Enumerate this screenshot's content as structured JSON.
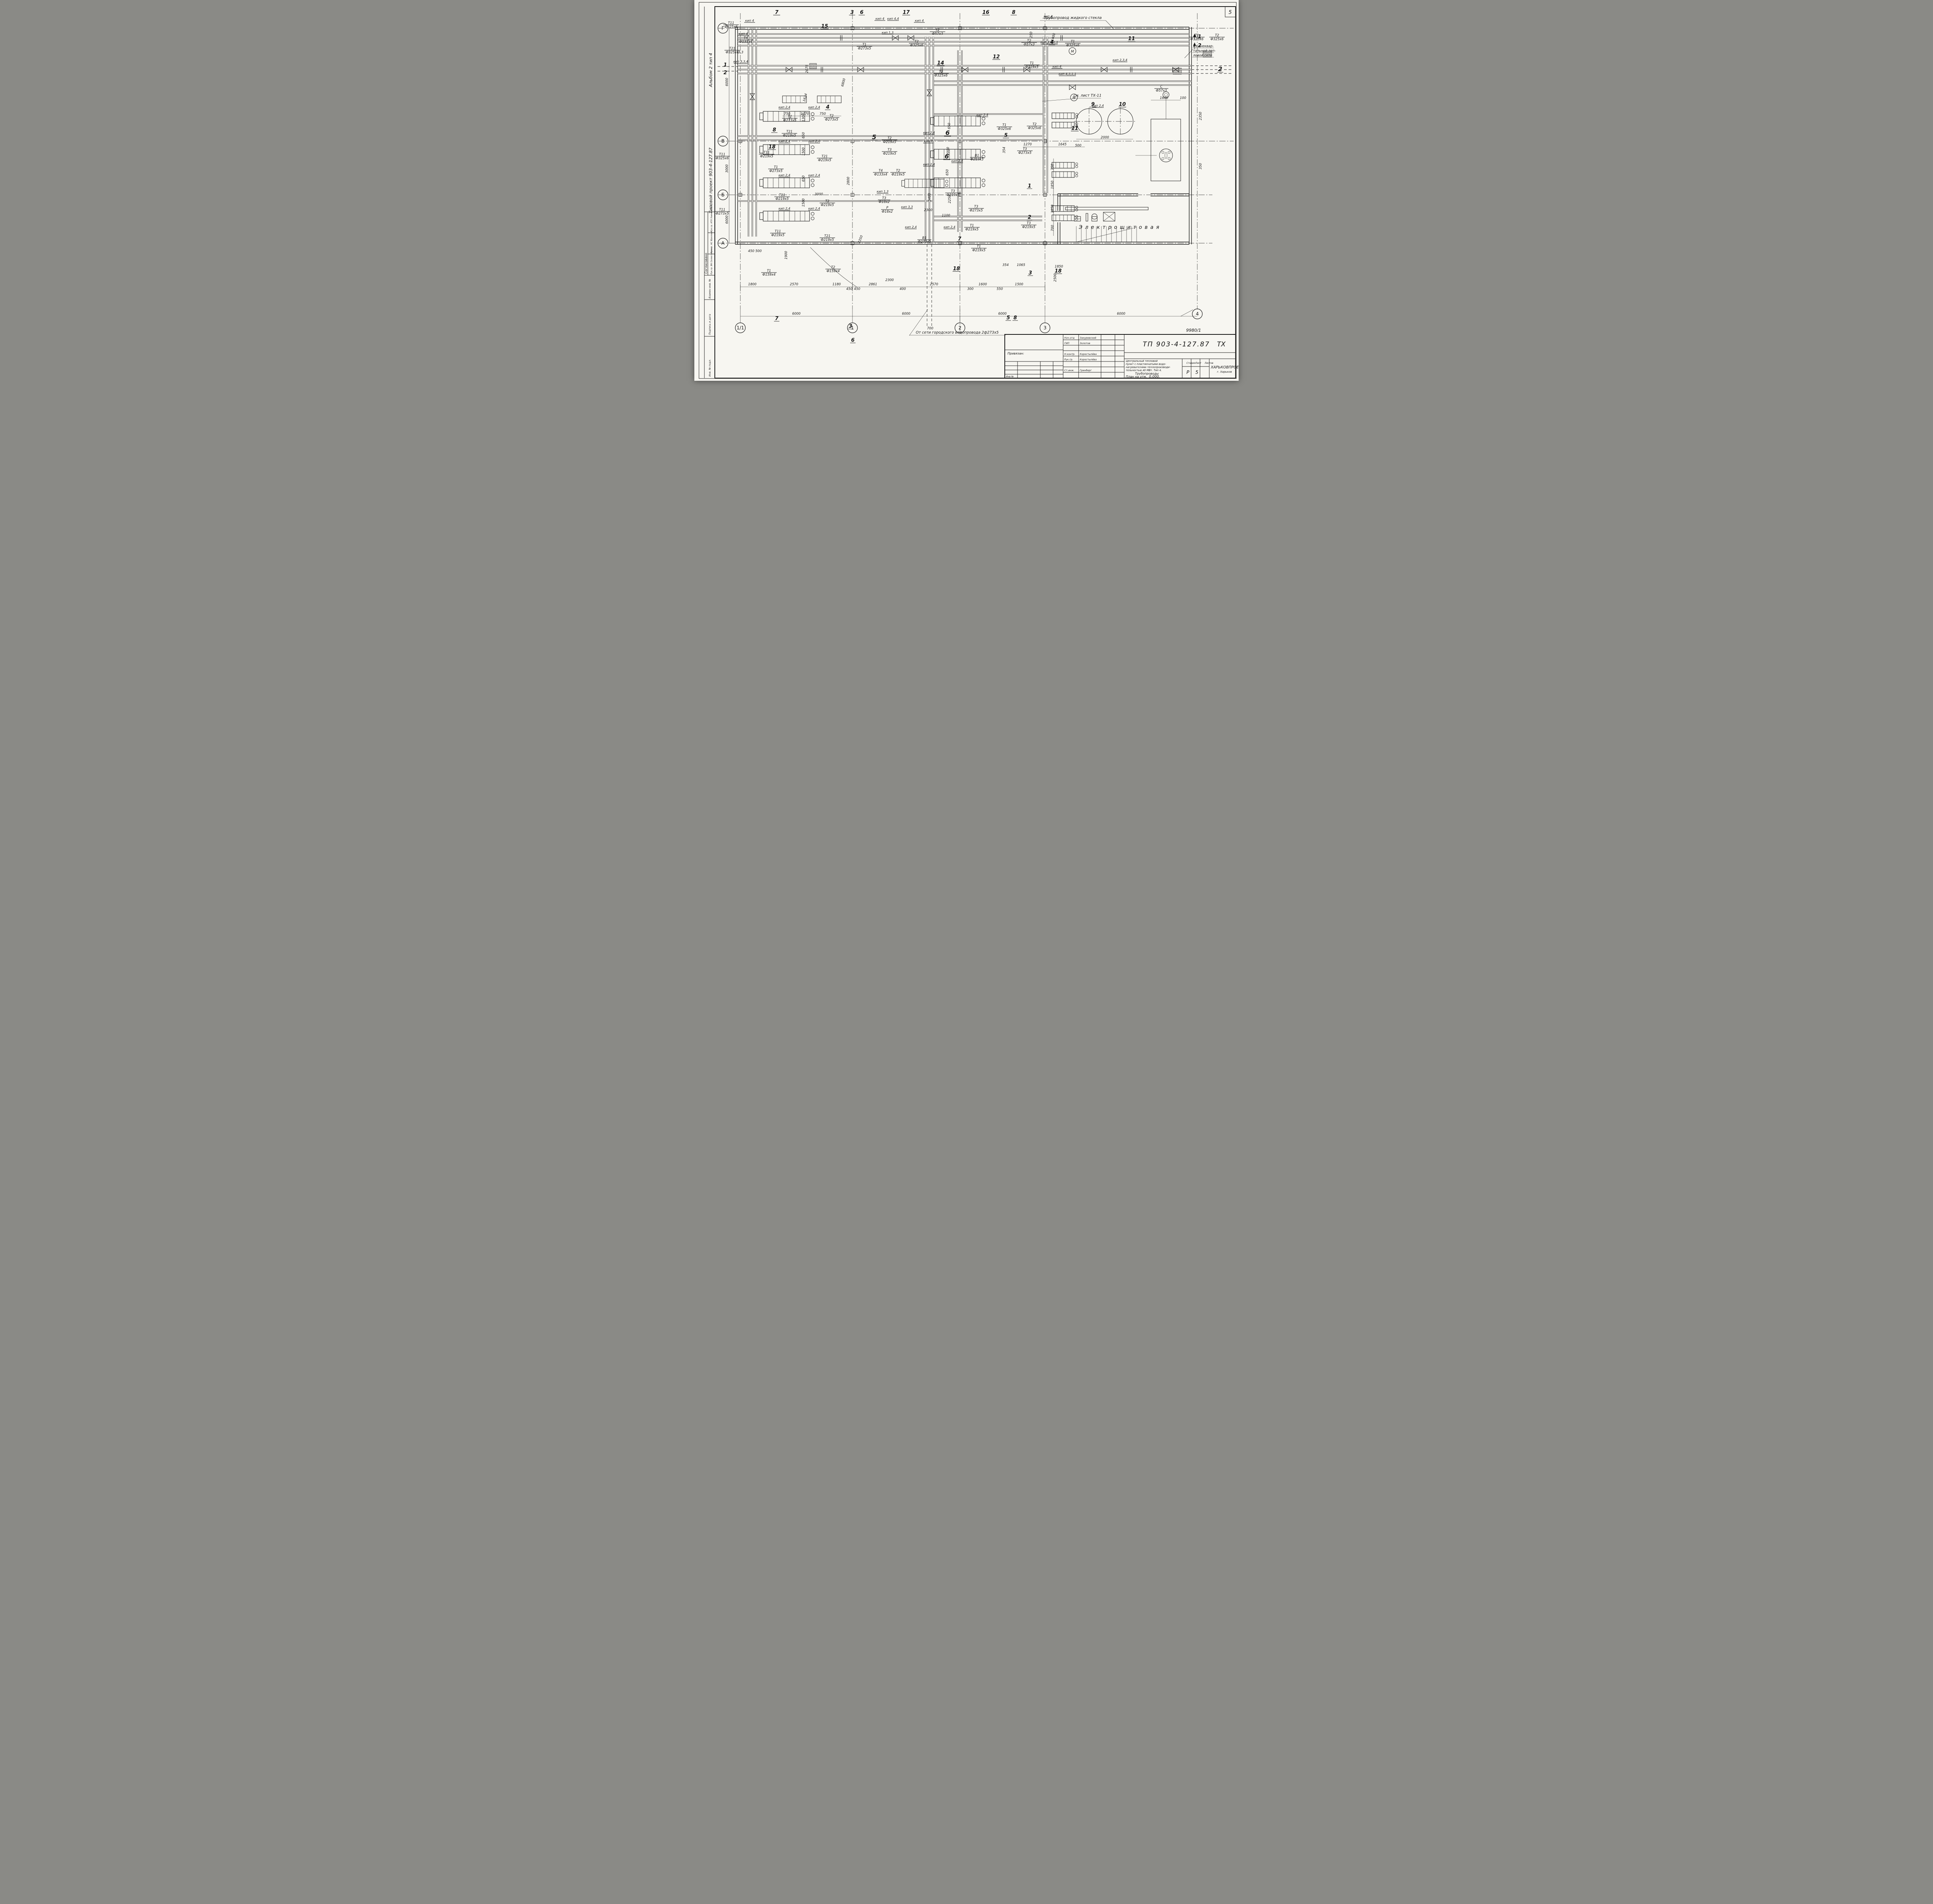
{
  "sheet": {
    "corner_sheet_no": "5",
    "doc_no": "9980/1",
    "code": "ТП  903-4-127.87",
    "code_suffix": "ТХ",
    "org": "ХАРЬКОВПРОЕКТ",
    "org_city": "г. Харьков",
    "stage_label": "Стадия",
    "sheet_label": "Лист",
    "sheets_label": "Листов",
    "stage": "Р",
    "sheet_no": "5",
    "desc1": "Центральный тепловой",
    "desc2": "пункт с пластинчатыми водо-",
    "desc3": "нагревателями теплопроизводи-",
    "desc4": "тельностью 40 МВт. Тип 4.",
    "pipe_line": "Трубопроводы",
    "plan_prefix": "План на отм.",
    "plan_elev": "0,000.",
    "binding": "Привязан:",
    "inv_no": "Инв №",
    "staff": [
      {
        "role": "Нач.отд",
        "name": "Закуревский"
      },
      {
        "role": "ГИП",
        "name": "Золотов"
      },
      {
        "role": "Н.контр.",
        "name": "Коростылёва"
      },
      {
        "role": "Рук.гр.",
        "name": "Коростылёва"
      },
      {
        "role": "Ст.инж.",
        "name": "Гринберг"
      }
    ]
  },
  "sidebar": {
    "project": "Типовой проект    903-4-127.87",
    "album": "Альбом 2  тип 4",
    "agreed": "Согласовано",
    "row1": "Рук.гр. АТХ  Хаимовский",
    "row2": "Рук.гр. АС  Фролова",
    "row3": "Рук.гр. ВК  Селистинова",
    "stamp1": "Взамен инв. №",
    "stamp2": "Подпись и дата",
    "stamp3": "Инв. № подл."
  },
  "axes": {
    "rows": [
      "Г",
      "В",
      "Б",
      "А"
    ],
    "cols": [
      "1/1",
      "1",
      "2",
      "3",
      "4"
    ]
  },
  "notes": {
    "liquid_glass": "Трубопровод жидкого стекла",
    "city_water": "От сети городского водопровода 2ф273х5",
    "ext1": "Из внеквар-",
    "ext2": "тальной теп-",
    "ext3": "ловой сети",
    "see_sheet": "см. лист ТХ-11",
    "room": "Электрощитовая"
  },
  "tags": {
    "kip4": "кип 4",
    "kip44": "кип 4,4",
    "kip24": "кип 2,4",
    "kip33": "кип 3,3",
    "kip13": "кип 1,3",
    "kip7": "кип 7",
    "kip334": "кип 3,3,4",
    "kip3411": "кип 3,4,1,1",
    "kip4311": "кип 4,3,1,1",
    "kip234": "кип 2,3,4",
    "t11_325": {
      "c": "Т11",
      "d": "Ф325х6"
    },
    "t11_273": {
      "c": "Т11",
      "d": "Ф273х5"
    },
    "t11_219": {
      "c": "Т11",
      "d": "Ф219х5"
    },
    "t21_325": {
      "c": "Т21",
      "d": "Ф325х6"
    },
    "t21_219": {
      "c": "Т21",
      "d": "Ф219х5"
    },
    "t1_325": {
      "c": "Т1",
      "d": "Ф325х6"
    },
    "t1_273": {
      "c": "Т1",
      "d": "Ф273х5"
    },
    "t1_219": {
      "c": "Т1",
      "d": "Ф219х5"
    },
    "t1_159": {
      "c": "Т1",
      "d": "Ф159х4"
    },
    "t2_325": {
      "c": "Т2",
      "d": "Ф325х6"
    },
    "t2_273": {
      "c": "Т2",
      "d": "Ф273х5"
    },
    "t2_219": {
      "c": "Т2",
      "d": "Ф219х5"
    },
    "t2_159": {
      "c": "Т2",
      "d": "Ф159х4"
    },
    "t2_57": {
      "c": "Т2",
      "d": "Ф57х3"
    },
    "t3_273": {
      "c": "Т3",
      "d": "Ф273х5"
    },
    "t3_219": {
      "c": "Т3",
      "d": "Ф219х5"
    },
    "t3_18": {
      "c": "Т3",
      "d": "Ф18х2"
    },
    "t4_133": {
      "c": "Т4",
      "d": "Ф133х4"
    },
    "p_18": {
      "c": "Р",
      "d": "Ф18х2"
    },
    "v1_219": {
      "c": "В1",
      "d": "Ф219х5"
    },
    "v1_273": {
      "c": "В1",
      "d": "Ф273х5"
    },
    "c_57": {
      "c": "С",
      "d": "Ф57х3"
    }
  },
  "dims": {
    "d33": "3,3",
    "d100": "100",
    "d250": "250",
    "d300": "300",
    "d350": "350",
    "d354": "354",
    "d400": "400",
    "d450": "450",
    "d500": "500",
    "d550": "550",
    "d650": "650",
    "d700": "700",
    "d750": "750",
    "d1065": "1065",
    "d1100": "1100",
    "d1180": "1180",
    "d1270": "1270",
    "d1300": "1300",
    "d1400": "1400",
    "d1500": "1500",
    "d1600": "1600",
    "d1624": "1624",
    "d1645": "1645",
    "d1770": "1770",
    "d1800": "1800",
    "d1850": "1850",
    "d1900": "1900",
    "d2000": "2000",
    "d2076": "2076",
    "d2250": "2250",
    "d2300": "2300",
    "d2350": "2350",
    "d2500": "2500",
    "d2570": "2570",
    "d2800": "2800",
    "d2861": "2861",
    "d3000": "3000",
    "d5400": "5400",
    "d6000": "6000",
    "d6800": "6800"
  },
  "markers": {
    "m1": "1",
    "m2": "2",
    "m3": "3",
    "m4": "4",
    "m5": "5",
    "m6": "6",
    "m7": "7",
    "m8": "8",
    "m9": "9",
    "m10": "10",
    "m11": "11",
    "m12": "12",
    "m14": "14",
    "m15": "15",
    "m16": "16",
    "m17": "17",
    "m18": "18",
    "motor": "М"
  }
}
